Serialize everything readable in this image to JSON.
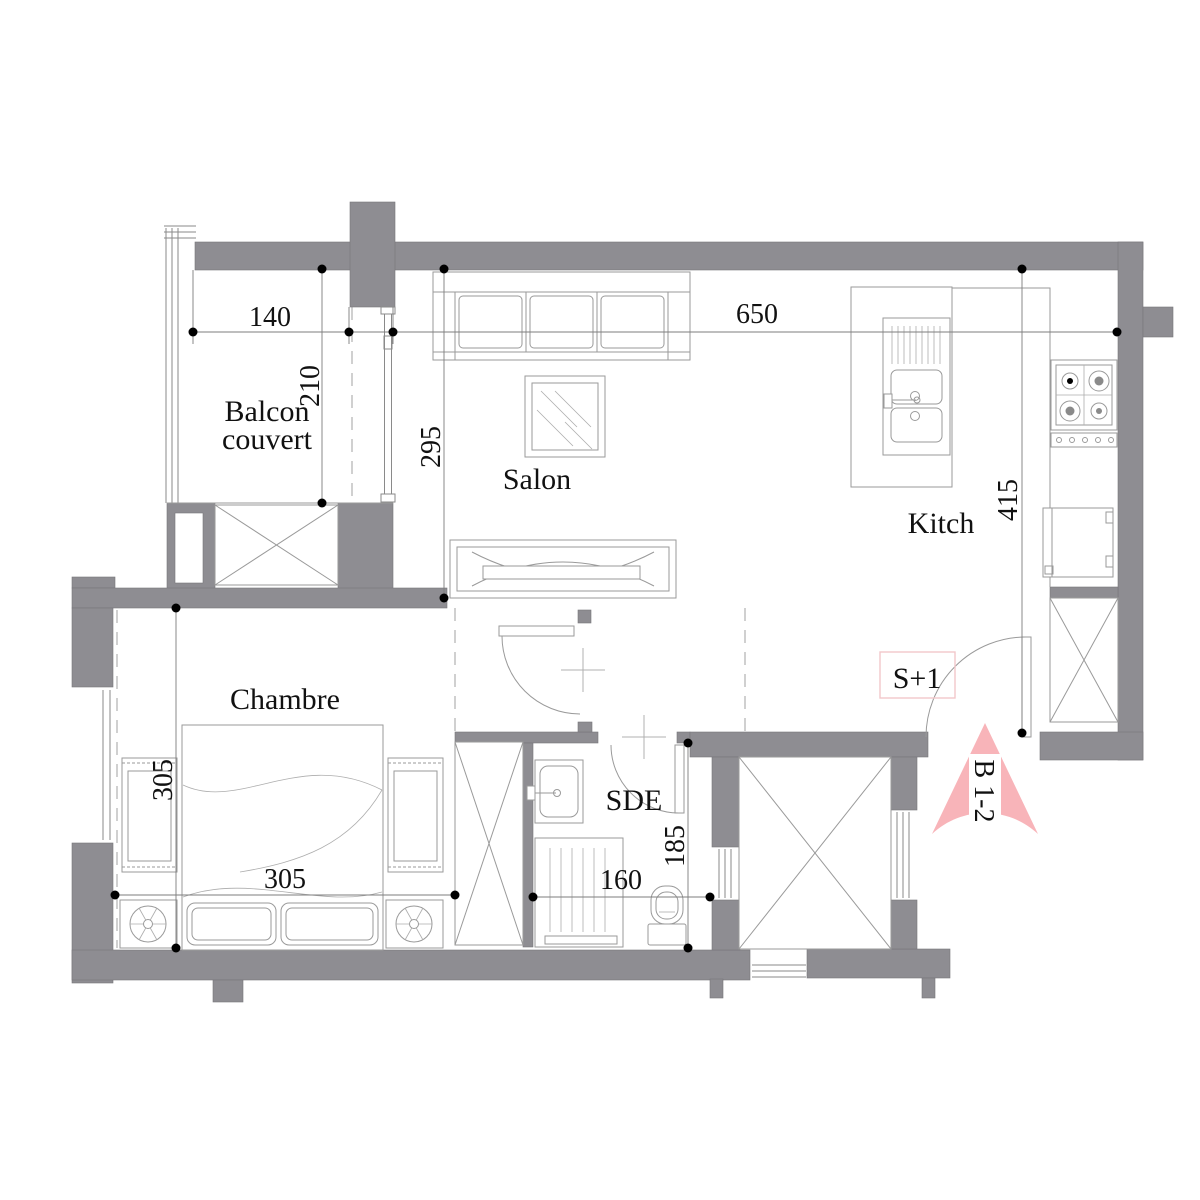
{
  "plan": {
    "rooms": {
      "balcony": {
        "line1": "Balcon",
        "line2": "couvert"
      },
      "salon": "Salon",
      "kitchen": "Kitch",
      "bedroom": "Chambre",
      "shower": "SDE"
    },
    "labels": {
      "unit": "S+1",
      "block": "B 1-2"
    },
    "dims": {
      "balcony_w": "140",
      "balcony_d": "210",
      "salon_d": "295",
      "living_w": "650",
      "kitchen_d": "415",
      "bedroom_d": "305",
      "bedroom_w": "305",
      "sde_d": "185",
      "sde_w": "160"
    },
    "colors": {
      "wall_gray": "#8e8d92",
      "arrow_pink": "#f8b4b9",
      "unit_box_pink": "#f2c7ca",
      "line_gray": "#9a9a9a",
      "text_black": "#111111"
    }
  }
}
